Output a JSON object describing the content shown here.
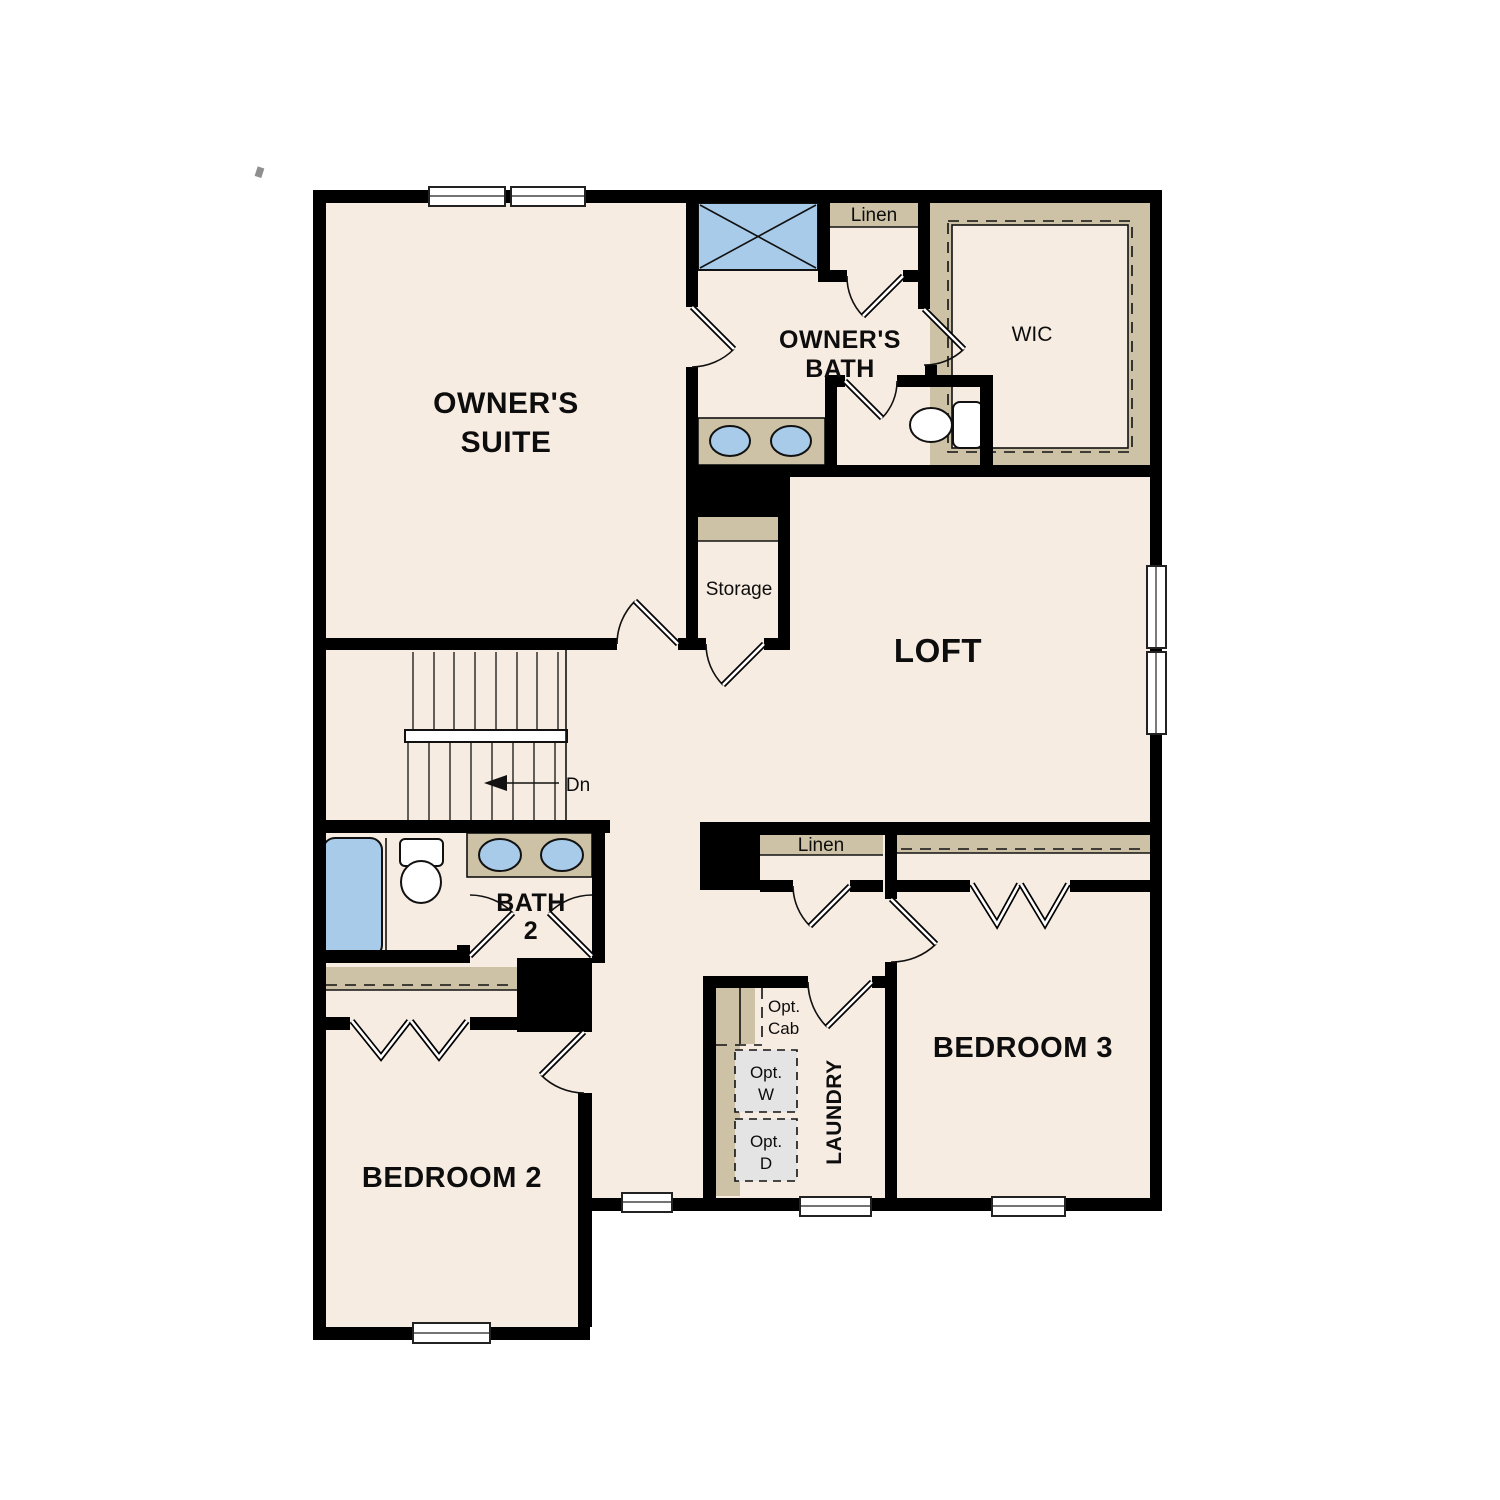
{
  "document": {
    "type": "residential-second-floor-plan"
  },
  "colors": {
    "floor": "#f7ece2",
    "wall": "#000000",
    "casework_tan": "#cdc2a6",
    "fixture_blue": "#a8cbe9",
    "optional_appliance_gray": "#e4e4e4",
    "background": "#ffffff"
  },
  "labels": {
    "owners_suite_line1": "OWNER'S",
    "owners_suite_line2": "SUITE",
    "owners_bath_line1": "OWNER'S",
    "owners_bath_line2": "BATH",
    "wic": "WIC",
    "loft": "LOFT",
    "storage": "Storage",
    "bath2_line1": "BATH",
    "bath2_line2": "2",
    "bedroom2": "BEDROOM 2",
    "bedroom3": "BEDROOM 3",
    "laundry": "LAUNDRY",
    "linen_owners": "Linen",
    "linen_hall": "Linen",
    "stairs_down": "Dn",
    "opt_cab_line1": "Opt.",
    "opt_cab_line2": "Cab",
    "opt_w_line1": "Opt.",
    "opt_w_line2": "W",
    "opt_d_line1": "Opt.",
    "opt_d_line2": "D"
  },
  "rooms": [
    {
      "name": "owners-suite",
      "label": "OWNER'S SUITE"
    },
    {
      "name": "owners-bath",
      "label": "OWNER'S BATH"
    },
    {
      "name": "walk-in-closet",
      "label": "WIC"
    },
    {
      "name": "loft",
      "label": "LOFT"
    },
    {
      "name": "storage",
      "label": "Storage"
    },
    {
      "name": "bath-2",
      "label": "BATH 2"
    },
    {
      "name": "bedroom-2",
      "label": "BEDROOM 2"
    },
    {
      "name": "bedroom-3",
      "label": "BEDROOM 3"
    },
    {
      "name": "laundry",
      "label": "LAUNDRY"
    },
    {
      "name": "linen-owners",
      "label": "Linen"
    },
    {
      "name": "linen-hall",
      "label": "Linen"
    }
  ]
}
